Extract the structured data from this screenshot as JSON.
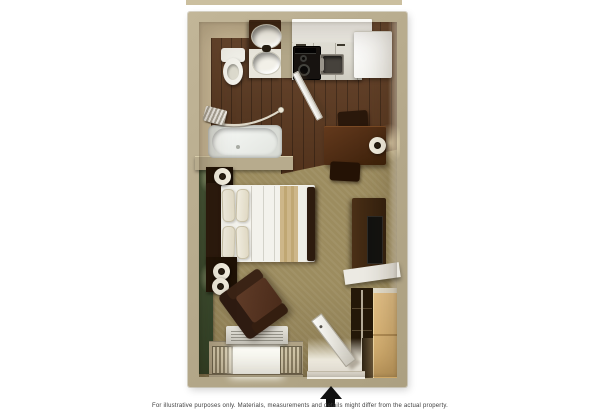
{
  "image": {
    "type": "floor-plan-rendering",
    "description": "3D top-down floor plan of a studio suite with bathroom, kitchenette, queen bed, dining table, TV stand, closet, armchair and entry door"
  },
  "caption": {
    "text": "For illustrative purposes only.  Materials, measurements and details might differ from the actual property."
  },
  "entrance_arrow": {
    "symbol": "solid-up-arrow",
    "meaning": "unit entrance"
  },
  "palette": {
    "background": "#ffffff",
    "wall_tan": "#b6aa8c",
    "wood_floor": "#5e3a20",
    "carpet_olive": "#9c8c5f",
    "accent_wall_green": "#3d5230",
    "counter_white": "#f2f1ea",
    "dark_wood_furniture": "#33200f",
    "closet_tan": "#ddba7e",
    "bed_white": "#f3f2ec",
    "bed_runner_tan": "#c7b083",
    "arrow_black": "#101010",
    "caption_gray": "#3c3c3c"
  },
  "rooms": {
    "bathroom": {
      "fixtures": [
        "vanity-sink-upper",
        "vanity-sink-lower",
        "toilet",
        "bathtub",
        "shower-curtain-rod",
        "towel"
      ]
    },
    "kitchen": {
      "fixtures": [
        "countertop",
        "cooktop",
        "kitchen-sink",
        "refrigerator",
        "bathroom-door-open"
      ]
    },
    "main_room": {
      "furniture": [
        "dining-table",
        "dining-chair-north",
        "dining-chair-south",
        "table-lamp",
        "queen-bed",
        "headboard",
        "pillows-x4",
        "bed-runner",
        "nightstand-north",
        "nightstand-south",
        "nightstand-lamps-x3",
        "tv-stand",
        "television",
        "wall-shelf",
        "closet-shelving",
        "closet-door-panel",
        "armchair",
        "ac-unit",
        "window-with-blinds",
        "entry-door-open"
      ]
    }
  }
}
